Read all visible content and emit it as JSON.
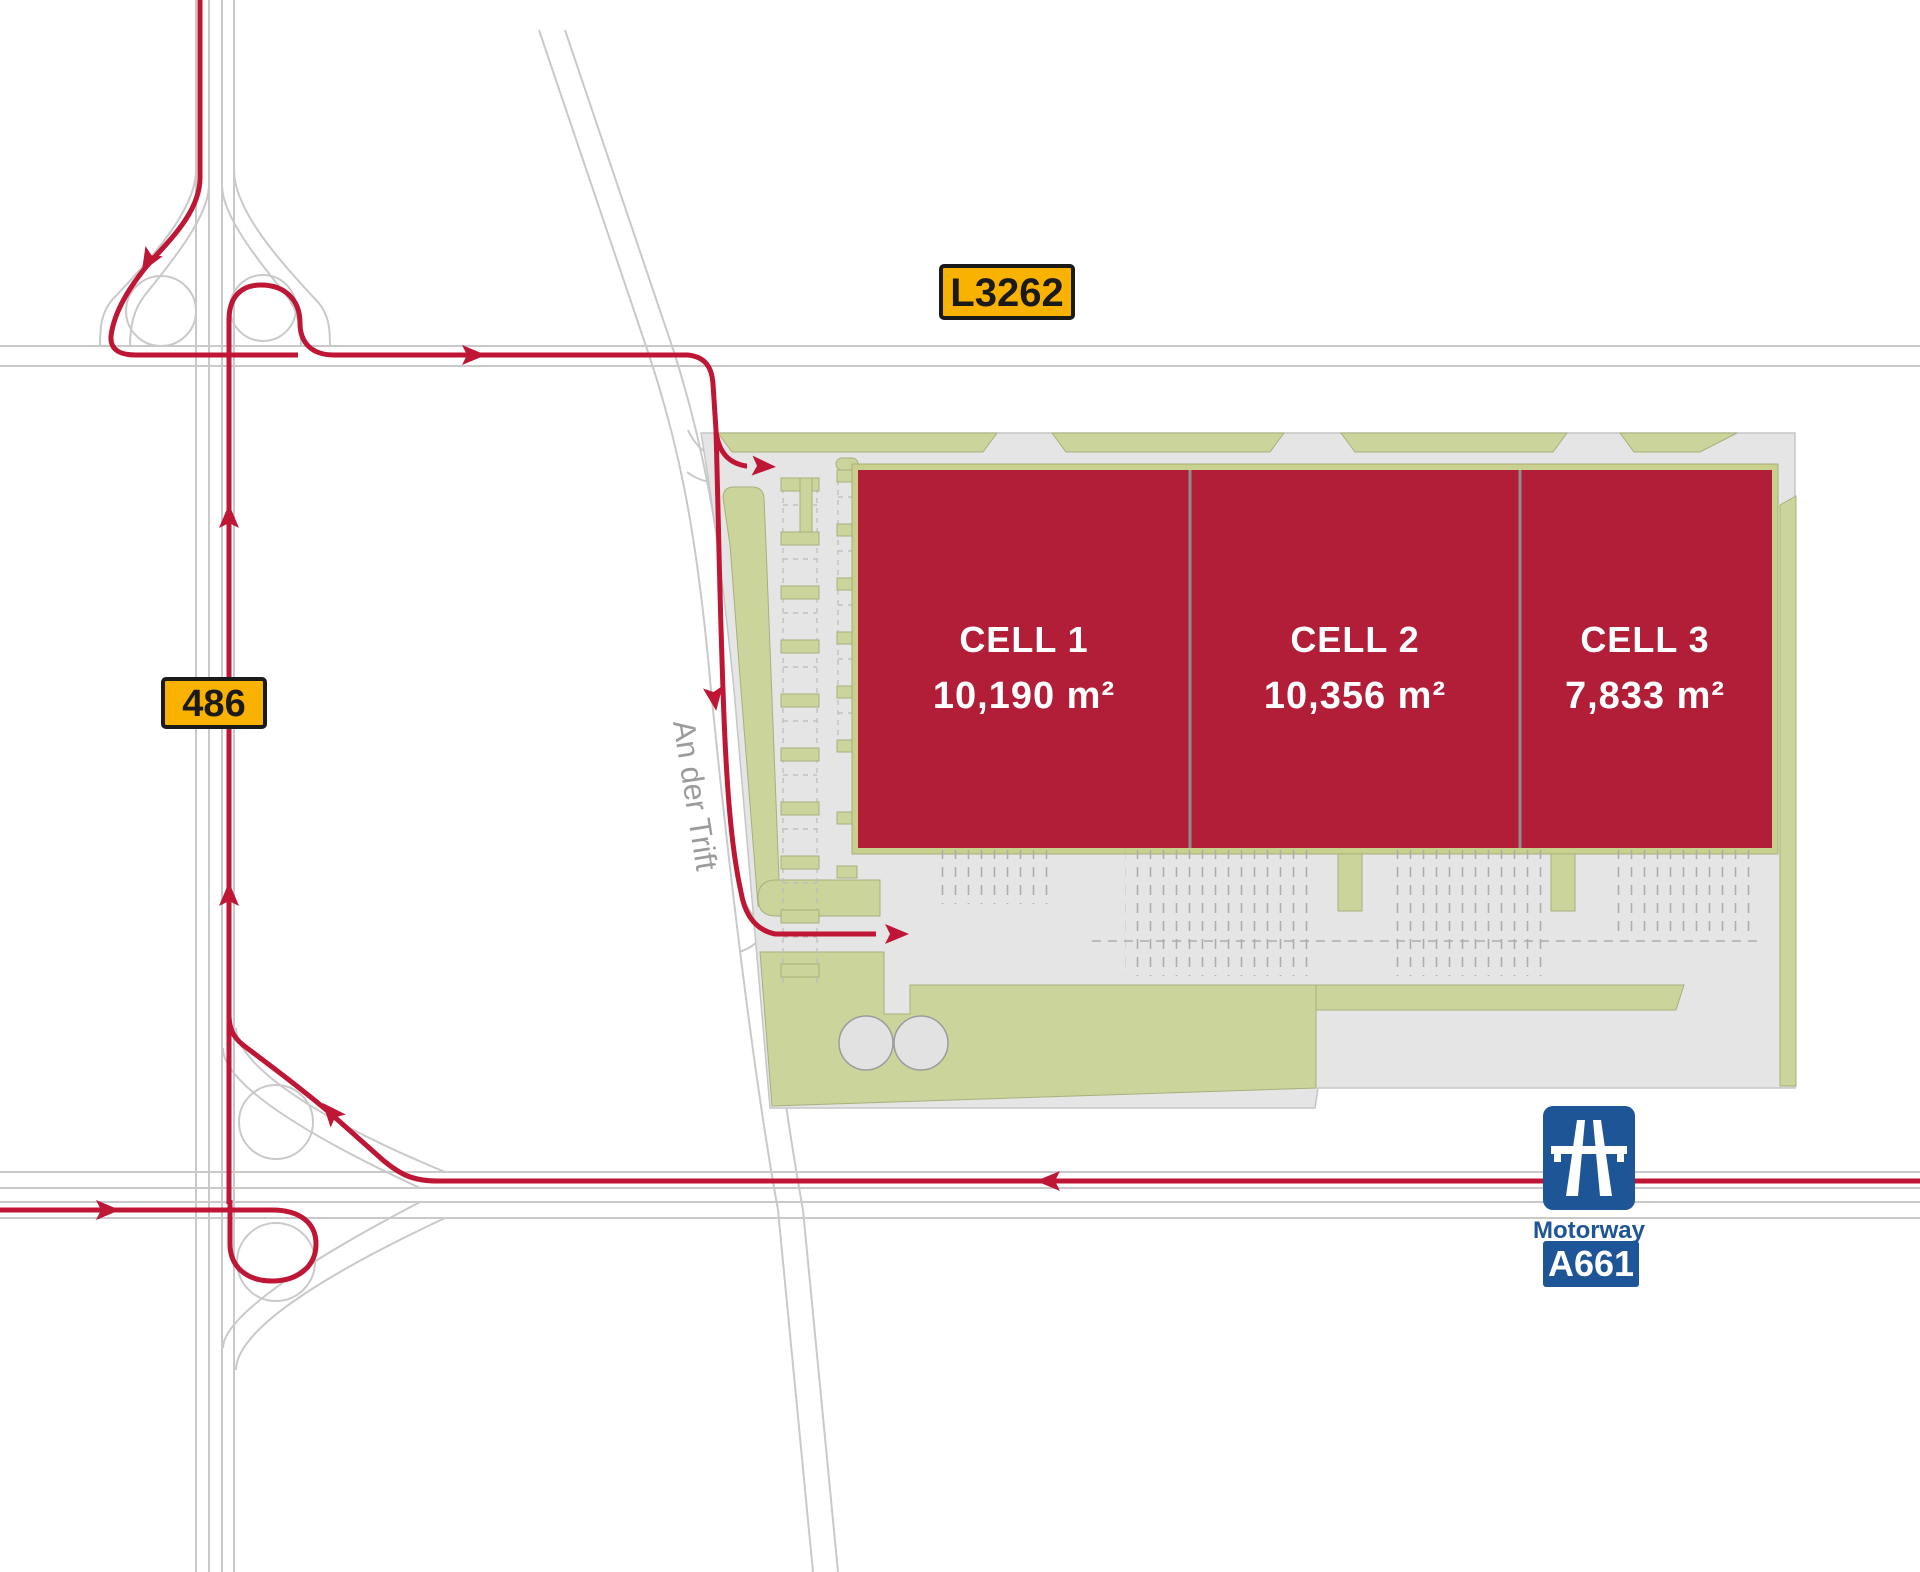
{
  "roads": {
    "l3262": {
      "label": "L3262"
    },
    "b486": {
      "label": "486"
    },
    "a661": {
      "label": "A661",
      "type_label": "Motorway"
    },
    "street": {
      "label": "An der Trift"
    }
  },
  "site": {
    "cells": [
      {
        "name": "CELL 1",
        "area": "10,190 m²"
      },
      {
        "name": "CELL 2",
        "area": "10,356 m²"
      },
      {
        "name": "CELL 3",
        "area": "7,833 m²"
      }
    ]
  },
  "colors": {
    "route_red": "#BE1634",
    "building_red": "#B21E38",
    "landscape_green": "#CBD49B",
    "pavement_gray": "#E5E5E6",
    "badge_yellow": "#F9B200",
    "motorway_blue": "#1E5596",
    "road_line_gray": "#C9C9C9",
    "street_text_gray": "#9B9B9B"
  }
}
